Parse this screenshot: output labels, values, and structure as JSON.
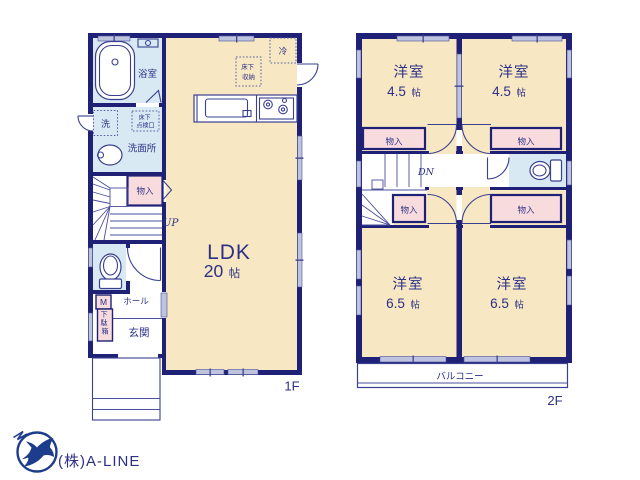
{
  "floor1": {
    "floor_label": "1F",
    "bathroom": "浴室",
    "washer": "洗",
    "underfloor_access": [
      "床下",
      "点検口"
    ],
    "washroom": "洗面所",
    "closet": "物入",
    "stairs_up": "UP",
    "ldk": "LDK",
    "ldk_size": "20",
    "size_unit": "帖",
    "underfloor_storage": [
      "床下",
      "収納"
    ],
    "refrigerator": "冷",
    "meter": "M",
    "shoe_cabinet": [
      "下",
      "駄",
      "箱"
    ],
    "hall": "ホール",
    "entrance": "玄関"
  },
  "floor2": {
    "floor_label": "2F",
    "western_room": "洋室",
    "size_45": "4.5",
    "size_65": "6.5",
    "size_unit": "帖",
    "closet": "物入",
    "stairs_down": "DN",
    "balcony": "バルコニー"
  },
  "footer": {
    "company": "(株)A-LINE"
  },
  "colors": {
    "wall_navy": "#1f2176",
    "room_cream": "#f7e7c3",
    "wet_blue": "#d8e9f4",
    "closet_pink": "#f8dbdd",
    "window_gray": "#bec4de",
    "logo_navy": "#1e3c8c",
    "footer_gray": "#cbcdd6"
  }
}
